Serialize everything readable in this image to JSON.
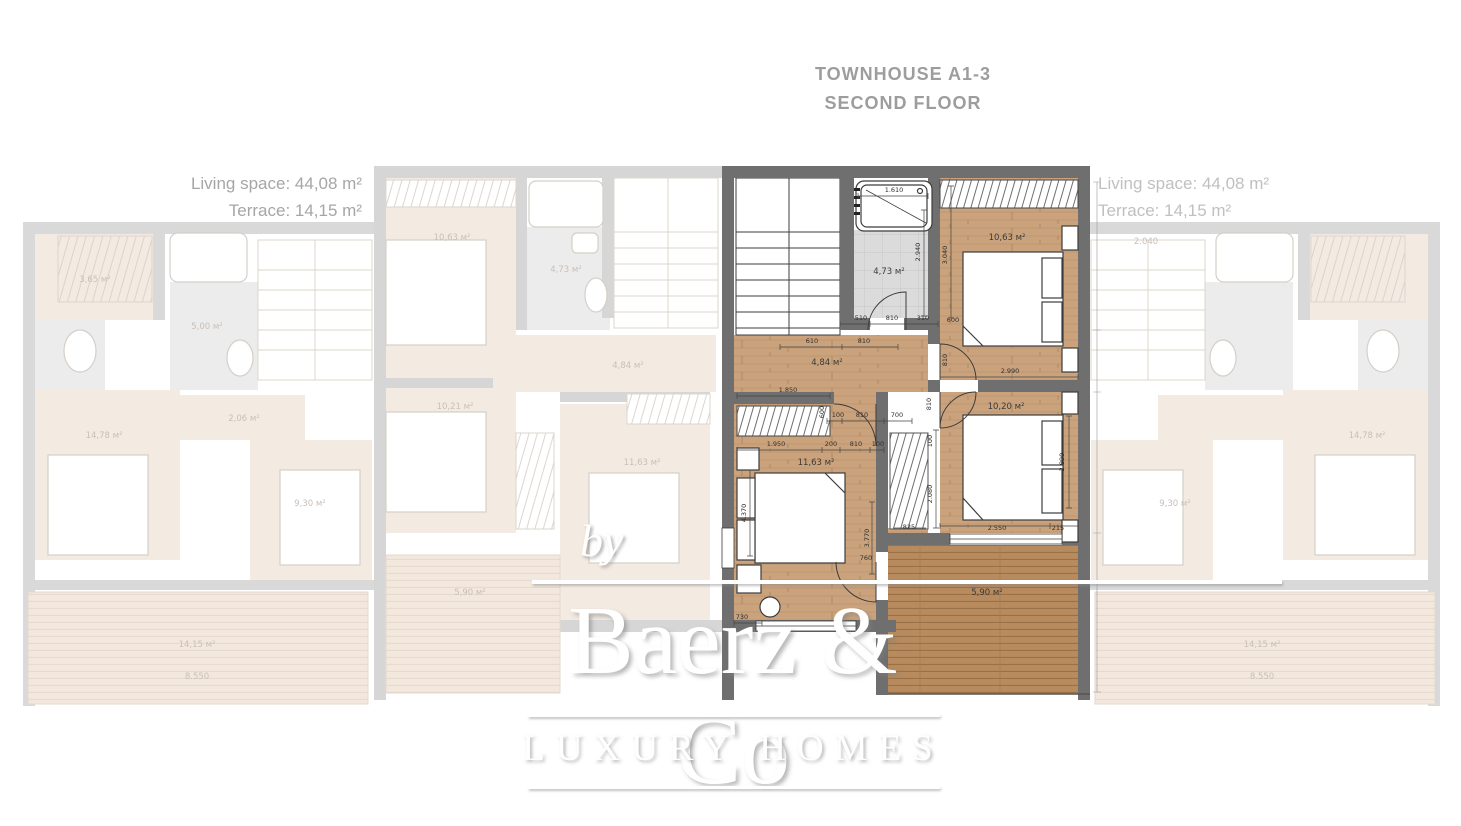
{
  "header": {
    "line1": "TOWNHOUSE A1-3",
    "line2": "SECOND FLOOR"
  },
  "stats_left": {
    "living": "Living space: 44,08 m²",
    "terrace": "Terrace: 14,15 m²"
  },
  "stats_right": {
    "living": "Living space: 44,08 m²",
    "terrace": "Terrace: 14,15 m²"
  },
  "watermark": {
    "prefix": "by",
    "brand": "Baerz & Co",
    "tagline": "LUXURY HOMES"
  },
  "colors": {
    "wall": "#6f6f6f",
    "wood": "#caa37c",
    "deck": "#b78b5e",
    "tile": "#dbdbdb",
    "title_gray": "#9d9d9d",
    "faded_label": "#c9bfb6"
  },
  "floorplan": {
    "unit": "A1-3",
    "floor": "Second floor",
    "rooms": [
      {
        "label": "4,73 м²",
        "x": 889,
        "y": 274
      },
      {
        "label": "10,63 м²",
        "x": 1007,
        "y": 240
      },
      {
        "label": "4,84 м²",
        "x": 827,
        "y": 365
      },
      {
        "label": "10,20 м²",
        "x": 1006,
        "y": 409
      },
      {
        "label": "11,63 м²",
        "x": 816,
        "y": 465
      },
      {
        "label": "5,90 м²",
        "x": 987,
        "y": 595
      }
    ],
    "dims": [
      {
        "t": "1.610",
        "x": 894,
        "y": 192
      },
      {
        "t": "2.940",
        "x": 920,
        "y": 252,
        "r": -90
      },
      {
        "t": "3.040",
        "x": 947,
        "y": 255,
        "r": -90
      },
      {
        "t": "510",
        "x": 861,
        "y": 320
      },
      {
        "t": "810",
        "x": 892,
        "y": 320
      },
      {
        "t": "310",
        "x": 923,
        "y": 320
      },
      {
        "t": "600",
        "x": 953,
        "y": 322
      },
      {
        "t": "610",
        "x": 812,
        "y": 343
      },
      {
        "t": "810",
        "x": 864,
        "y": 343
      },
      {
        "t": "810",
        "x": 947,
        "y": 360,
        "r": -90
      },
      {
        "t": "2.990",
        "x": 1010,
        "y": 373
      },
      {
        "t": "1.850",
        "x": 788,
        "y": 392
      },
      {
        "t": "600",
        "x": 824,
        "y": 412,
        "r": -90
      },
      {
        "t": "100",
        "x": 838,
        "y": 417
      },
      {
        "t": "810",
        "x": 862,
        "y": 417
      },
      {
        "t": "700",
        "x": 897,
        "y": 417
      },
      {
        "t": "810",
        "x": 931,
        "y": 404,
        "r": -90
      },
      {
        "t": "1.950",
        "x": 776,
        "y": 446
      },
      {
        "t": "200",
        "x": 831,
        "y": 446
      },
      {
        "t": "810",
        "x": 856,
        "y": 446
      },
      {
        "t": "100",
        "x": 878,
        "y": 446
      },
      {
        "t": "2.890",
        "x": 1064,
        "y": 462,
        "r": -90
      },
      {
        "t": "100",
        "x": 932,
        "y": 441,
        "r": -90
      },
      {
        "t": "2.080",
        "x": 932,
        "y": 494,
        "r": -90
      },
      {
        "t": "4.370",
        "x": 746,
        "y": 513,
        "r": -90
      },
      {
        "t": "3.770",
        "x": 869,
        "y": 538,
        "r": -90
      },
      {
        "t": "760",
        "x": 866,
        "y": 560
      },
      {
        "t": "825",
        "x": 909,
        "y": 529
      },
      {
        "t": "2.550",
        "x": 997,
        "y": 530
      },
      {
        "t": "215",
        "x": 1058,
        "y": 530
      },
      {
        "t": "730",
        "x": 742,
        "y": 619
      }
    ]
  },
  "faded_units": {
    "labels": [
      {
        "t": "3,65 м²",
        "x": 95,
        "y": 282
      },
      {
        "t": "5,00 м²",
        "x": 207,
        "y": 329
      },
      {
        "t": "2,06 м²",
        "x": 244,
        "y": 421
      },
      {
        "t": "14,78 м²",
        "x": 104,
        "y": 438
      },
      {
        "t": "9,30 м²",
        "x": 310,
        "y": 506
      },
      {
        "t": "14,15 м²",
        "x": 197,
        "y": 647
      },
      {
        "t": "8.550",
        "x": 197,
        "y": 679
      },
      {
        "t": "10,63 м²",
        "x": 452,
        "y": 240
      },
      {
        "t": "4,73 м²",
        "x": 566,
        "y": 272
      },
      {
        "t": "4,84 м²",
        "x": 628,
        "y": 368
      },
      {
        "t": "10,21 м²",
        "x": 455,
        "y": 409
      },
      {
        "t": "11,63 м²",
        "x": 642,
        "y": 465
      },
      {
        "t": "5,90 м²",
        "x": 470,
        "y": 595
      },
      {
        "t": "2.040",
        "x": 1146,
        "y": 244
      },
      {
        "t": "14,78 м²",
        "x": 1367,
        "y": 438
      },
      {
        "t": "9,30 м²",
        "x": 1175,
        "y": 506
      },
      {
        "t": "14,15 м²",
        "x": 1262,
        "y": 647
      },
      {
        "t": "8.550",
        "x": 1262,
        "y": 679
      }
    ]
  }
}
